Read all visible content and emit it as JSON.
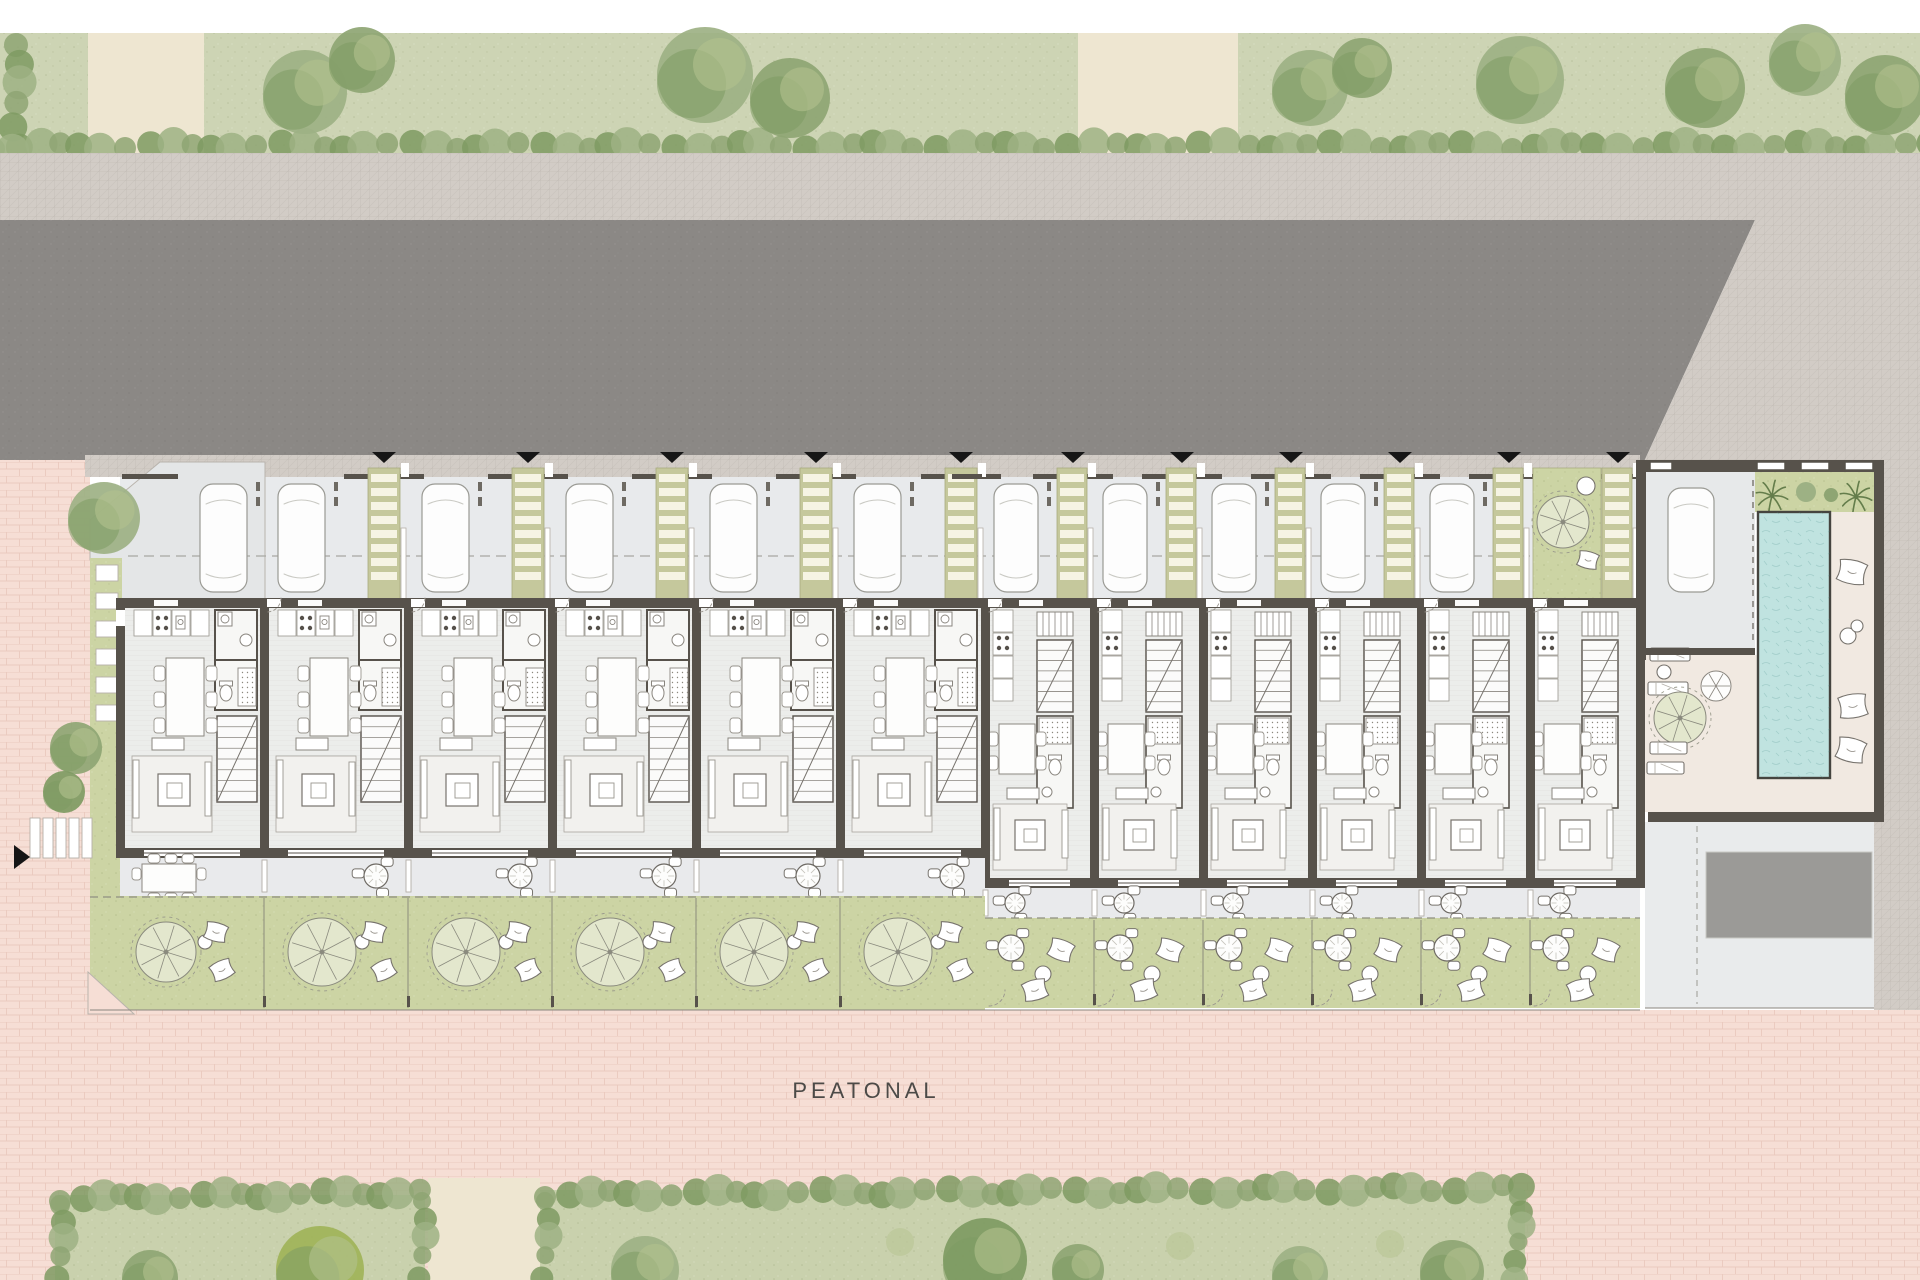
{
  "plan": {
    "label_peatonal": "PEATONAL",
    "drawing_type": "residential site plan",
    "street_side": "top",
    "arrow_count": 11,
    "car_count": 12,
    "units": [
      {
        "id": "unit-01",
        "group": "left",
        "features": [
          "kitchen",
          "dining",
          "bath",
          "stairs",
          "living",
          "terrace-dining",
          "garden-tree"
        ]
      },
      {
        "id": "unit-02",
        "group": "left",
        "features": [
          "parking",
          "pergola",
          "kitchen",
          "dining",
          "bath",
          "stairs",
          "living",
          "terrace",
          "garden-tree"
        ]
      },
      {
        "id": "unit-03",
        "group": "left",
        "features": [
          "parking",
          "pergola",
          "kitchen",
          "dining",
          "bath",
          "stairs",
          "living",
          "terrace",
          "garden-tree"
        ]
      },
      {
        "id": "unit-04",
        "group": "left",
        "features": [
          "parking",
          "pergola",
          "kitchen",
          "dining",
          "bath",
          "stairs",
          "living",
          "terrace",
          "garden-tree"
        ]
      },
      {
        "id": "unit-05",
        "group": "left",
        "features": [
          "parking",
          "pergola",
          "kitchen",
          "dining",
          "bath",
          "stairs",
          "living",
          "terrace",
          "garden-tree"
        ]
      },
      {
        "id": "unit-06",
        "group": "left",
        "features": [
          "parking",
          "pergola",
          "kitchen",
          "dining",
          "bath",
          "stairs",
          "living",
          "terrace",
          "garden-tree"
        ]
      },
      {
        "id": "unit-07",
        "group": "right",
        "features": [
          "parking",
          "pergola",
          "kitchen",
          "stairs",
          "bath",
          "dining",
          "living",
          "terrace",
          "garden-lounge"
        ]
      },
      {
        "id": "unit-08",
        "group": "right",
        "features": [
          "parking",
          "pergola",
          "kitchen",
          "stairs",
          "bath",
          "dining",
          "living",
          "terrace",
          "garden-lounge"
        ]
      },
      {
        "id": "unit-09",
        "group": "right",
        "features": [
          "parking",
          "pergola",
          "kitchen",
          "stairs",
          "bath",
          "dining",
          "living",
          "terrace",
          "garden-lounge"
        ]
      },
      {
        "id": "unit-10",
        "group": "right",
        "features": [
          "parking",
          "pergola",
          "kitchen",
          "stairs",
          "bath",
          "dining",
          "living",
          "terrace",
          "garden-lounge"
        ]
      },
      {
        "id": "unit-11",
        "group": "right",
        "features": [
          "parking",
          "pergola",
          "kitchen",
          "stairs",
          "bath",
          "dining",
          "living",
          "terrace",
          "garden-lounge"
        ]
      },
      {
        "id": "unit-12",
        "group": "right",
        "features": [
          "garden-forecourt",
          "pergola",
          "kitchen",
          "stairs",
          "bath",
          "dining",
          "living",
          "terrace",
          "garden-lounge"
        ]
      }
    ],
    "amenity": {
      "features": [
        "guest-garage",
        "lap-pool",
        "palm-planter",
        "sun-loungers",
        "pool-pillows",
        "spiral-feature",
        "service-pad"
      ]
    },
    "landscape": {
      "top_band": [
        "hedge-row",
        "street-trees",
        "two-paths"
      ],
      "bottom_band": [
        "hedge-parcel-west",
        "hedge-parcel-east",
        "path-gap"
      ]
    },
    "colors": {
      "white": "#ffffff",
      "grass_band": "#cdd4b4",
      "path_beige": "#eee6d1",
      "road": "#8b8885",
      "sidewalk": "#d2ccc6",
      "brick_pink": "#f6ded5",
      "brick_line": "#eac9be",
      "parking_floor": "#e8eaec",
      "pergola": "#c5c89c",
      "pergola_slat": "#f6f4e4",
      "wall": "#57524b",
      "house_floor": "#ecedeb",
      "bath_floor": "#f7f7f5",
      "fixture": "#8a867f",
      "furniture": "#77736d",
      "rug": "#f2f1ee",
      "terrace_floor": "#e9eaec",
      "garden_green": "#ccd4a4",
      "garden_tree": "#e3e7cd",
      "pool_blue": "#c0e3e0",
      "pool_rim": "#45443f",
      "cream": "#f1e9e1",
      "court": "#e9ebec",
      "service_pad": "#9b9a97",
      "boundary": "#6b655e",
      "arrow_black": "#161616",
      "label_text": "#4c4a47",
      "hedge_1": "#8ea573",
      "hedge_2": "#7e9a62",
      "hedge_3": "#9db184",
      "palm": "#647d4b"
    }
  }
}
